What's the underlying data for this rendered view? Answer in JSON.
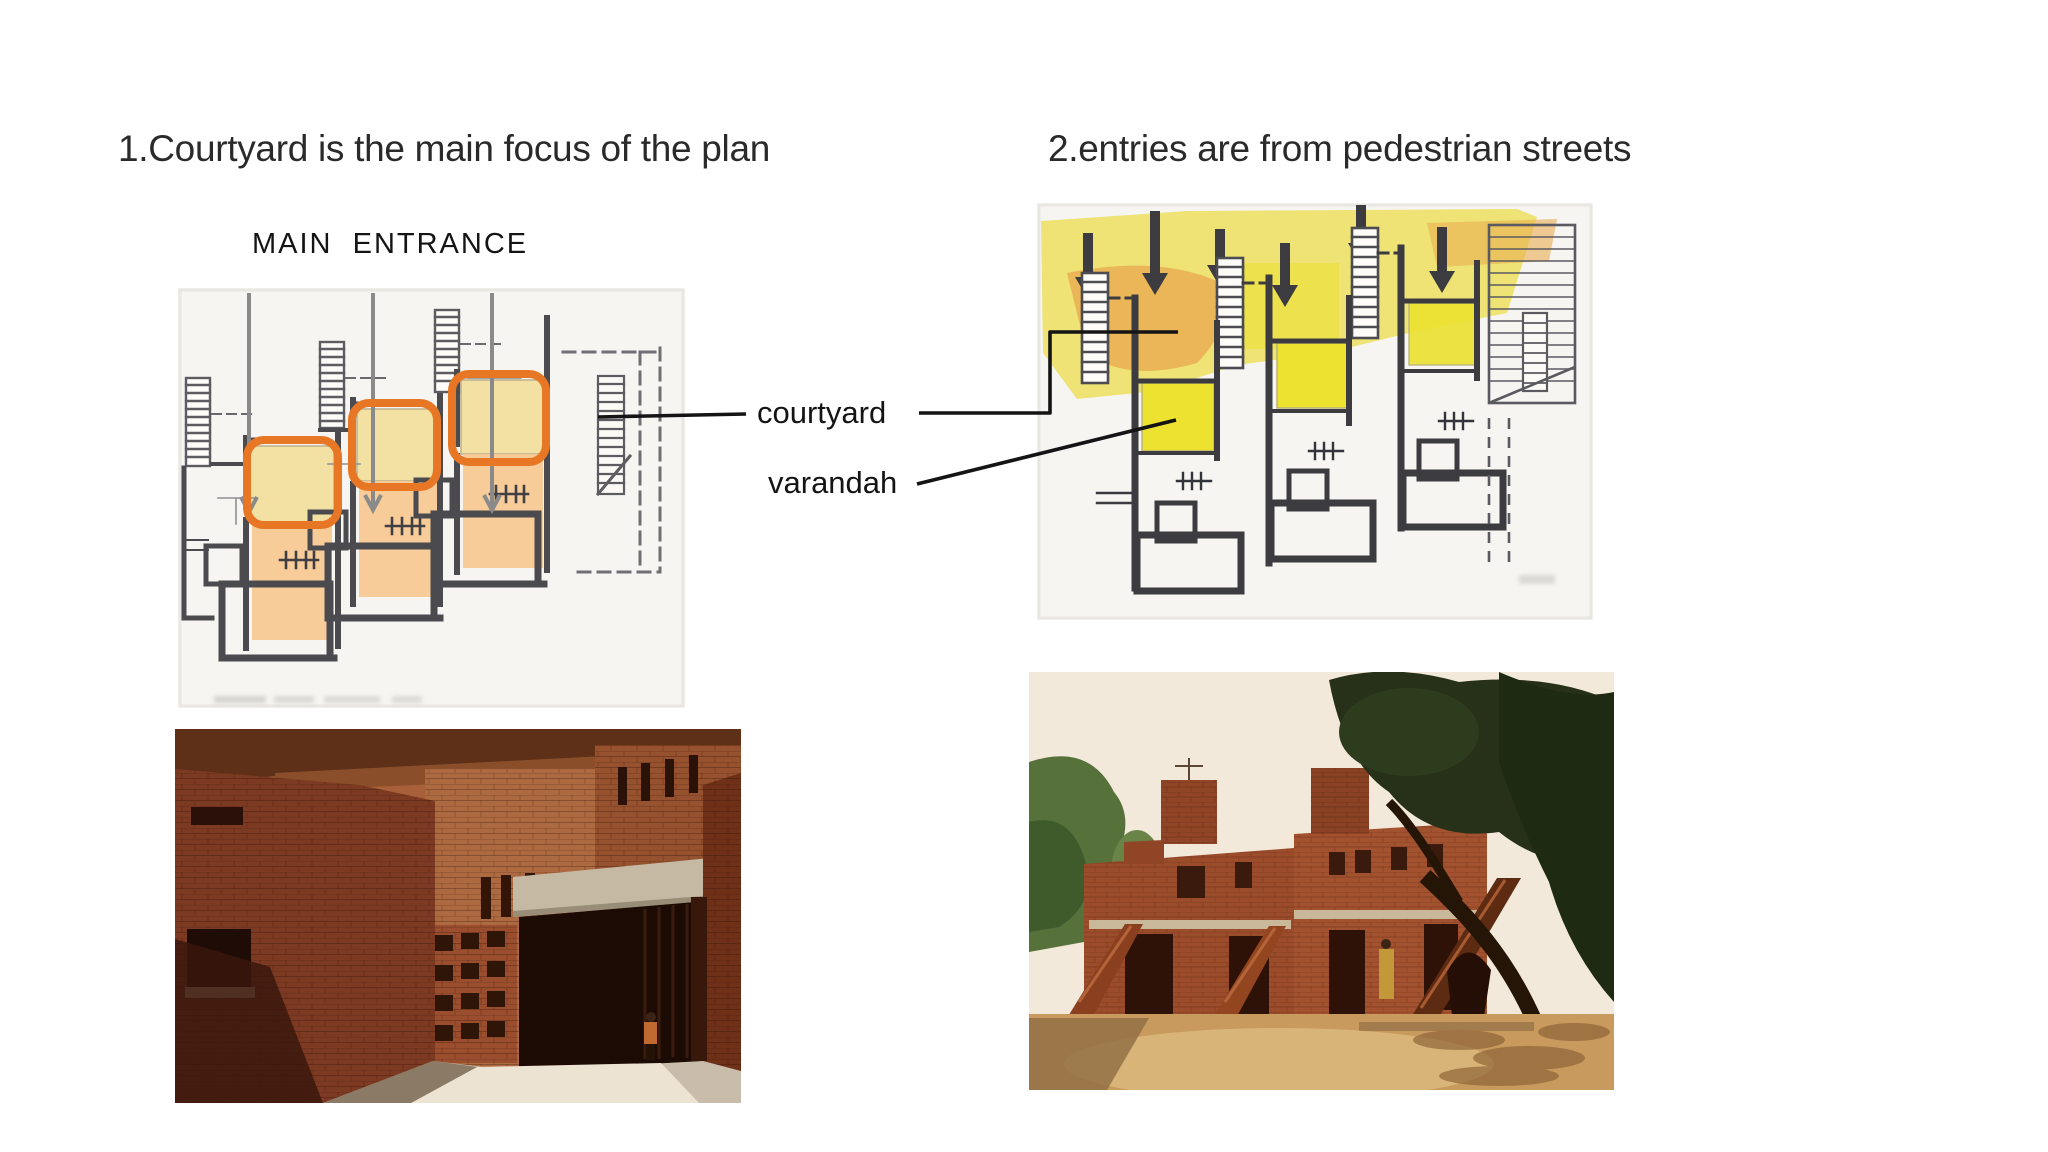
{
  "headings": {
    "left": "1.Courtyard is the main focus of the plan",
    "right": "2.entries are from pedestrian streets"
  },
  "plan_annotations": {
    "main_entrance_label": "MAIN  ENTRANCE",
    "courtyard_label": "courtyard",
    "varandah_label": "varandah"
  },
  "colors": {
    "background": "#ffffff",
    "heading_text": "#2a2a2a",
    "label_text": "#141414",
    "highlight_orange": "#e87725",
    "entrance_arrow_gray": "#8a8a8a",
    "leader_line": "#141414",
    "plan_paper": "#f6f5f2",
    "plan_wall": "#4a4a4f",
    "plan_wall_dark": "#3b3b40",
    "courtyard_yellow": "#f2e1a2",
    "courtyard_yellow_bright": "#ece22f",
    "varandah_peach": "#f8c992",
    "street_yellow": "#ecdf5e",
    "street_orange": "#e9ae52",
    "stair_green": "#b7d98b",
    "brick_red": "#8e4127",
    "brick_light": "#a8603a",
    "shadow_dark": "#2a130a",
    "concrete": "#c6b9a4",
    "sky": "#f2e9da",
    "sand": "#c89a5e",
    "tree_dark": "#27311a",
    "tree_green": "#5d7c3e"
  }
}
